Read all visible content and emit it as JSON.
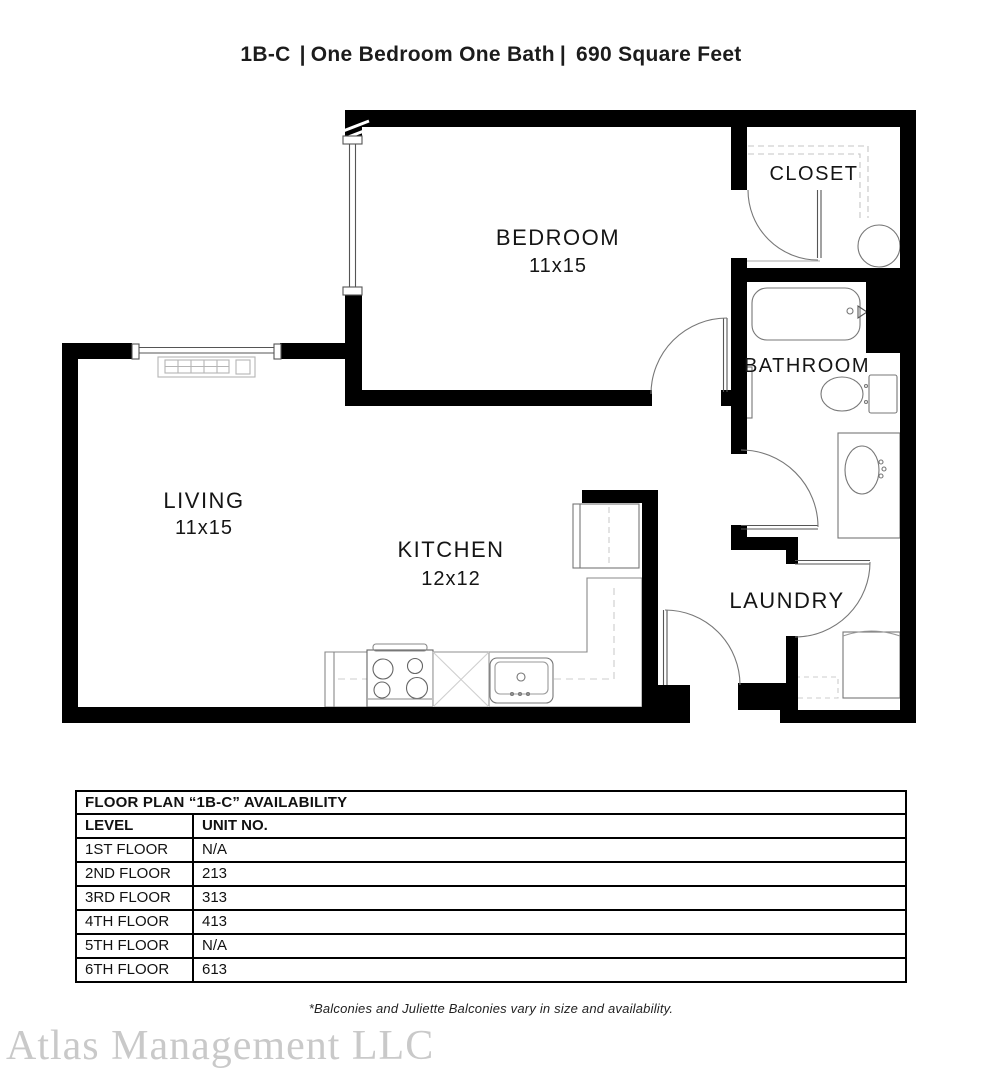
{
  "header": {
    "plan_code": "1B-C",
    "separator": "|",
    "description": "One Bedroom One Bath",
    "area": "690 Square Feet"
  },
  "plan": {
    "rooms": {
      "bedroom": {
        "label": "BEDROOM",
        "size": "11x15"
      },
      "closet": {
        "label": "CLOSET"
      },
      "bathroom": {
        "label": "BATHROOM"
      },
      "living": {
        "label": "LIVING",
        "size": "11x15"
      },
      "kitchen": {
        "label": "KITCHEN",
        "size": "12x12"
      },
      "laundry": {
        "label": "LAUNDRY"
      }
    }
  },
  "availability_table": {
    "title": "FLOOR PLAN “1B-C” AVAILABILITY",
    "columns": [
      "LEVEL",
      "UNIT NO."
    ],
    "rows": [
      {
        "level": "1ST FLOOR",
        "unit": "N/A"
      },
      {
        "level": "2ND FLOOR",
        "unit": "213"
      },
      {
        "level": "3RD FLOOR",
        "unit": "313"
      },
      {
        "level": "4TH FLOOR",
        "unit": "413"
      },
      {
        "level": "5TH FLOOR",
        "unit": "N/A"
      },
      {
        "level": "6TH FLOOR",
        "unit": "613"
      }
    ]
  },
  "footnote": "*Balconies and Juliette Balconies vary in size and availability.",
  "watermark": "Atlas Management LLC",
  "colors": {
    "wall": "#000000",
    "fixture_line": "#777777",
    "dashed_line": "#c5c5c5",
    "text": "#1a1a1a",
    "watermark": "#c9c9c9"
  }
}
